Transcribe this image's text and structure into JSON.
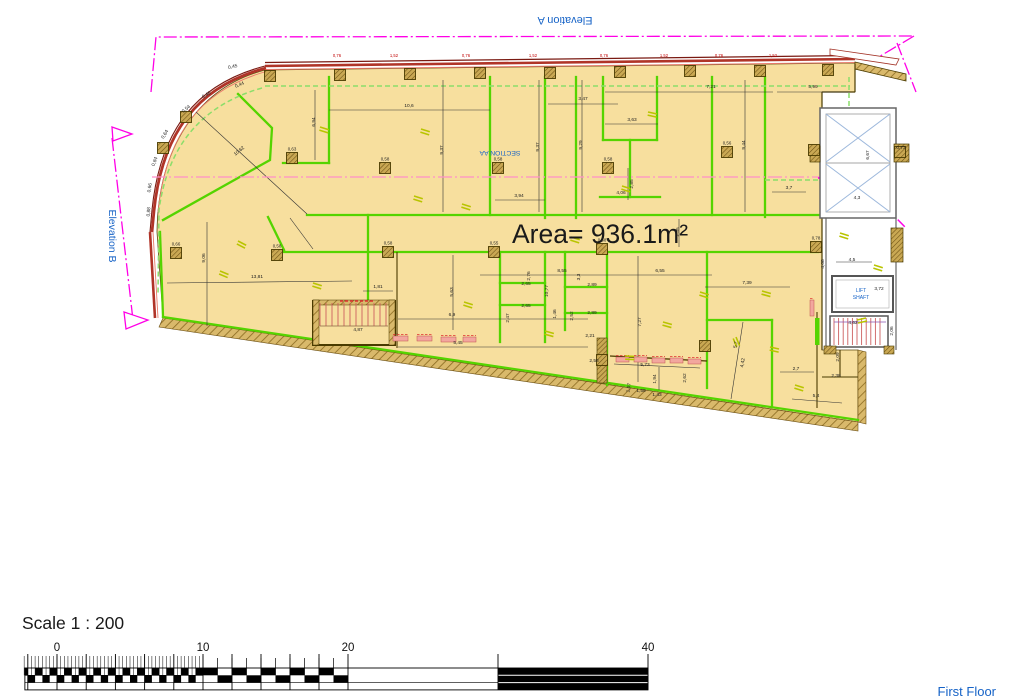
{
  "labels": {
    "area": "Area= 936.1m²",
    "elevation_a": "Elevation A",
    "elevation_b": "Elevation B",
    "section": "SECTION AA",
    "lift_line1": "LIFT",
    "lift_line2": "SHAFT",
    "scale": "Scale 1 : 200",
    "floor": "First Floor"
  },
  "colors": {
    "floor_fill": "#F7DF9E",
    "wall_green": "#55D400",
    "green_dashed": "#8CDE6A",
    "hatch_tan": "#D9B96B",
    "hatch_line": "#8A6A20",
    "wall_red": "#B03428",
    "wall_red_light": "#E8796A",
    "magenta": "#FF00E6",
    "section_pink": "#FF8FC8",
    "blue_text": "#1663C7",
    "brace_blue": "#9DB8DC",
    "dim_text": "#222222",
    "dim_red": "#C00000",
    "door_olive": "#B9C400",
    "sill_pink": "#F2A79E",
    "tread_red": "#CC5F5F",
    "tread_purple": "#8A55B0"
  },
  "scale_bar": {
    "labels": [
      {
        "t": "0",
        "v": 0,
        "x": 57
      },
      {
        "t": "10",
        "v": 10,
        "x": 203
      },
      {
        "t": "20",
        "v": 20,
        "x": 348
      },
      {
        "t": "40",
        "v": 40,
        "x": 648
      }
    ]
  },
  "dims": [
    {
      "t": "0,76",
      "x": 337,
      "y": 57,
      "c": "red"
    },
    {
      "t": "1,52",
      "x": 394,
      "y": 57,
      "c": "red"
    },
    {
      "t": "0,76",
      "x": 466,
      "y": 57,
      "c": "red"
    },
    {
      "t": "1,52",
      "x": 533,
      "y": 57,
      "c": "red"
    },
    {
      "t": "0,76",
      "x": 604,
      "y": 57,
      "c": "red"
    },
    {
      "t": "1,52",
      "x": 664,
      "y": 57,
      "c": "red"
    },
    {
      "t": "0,76",
      "x": 719,
      "y": 57,
      "c": "red"
    },
    {
      "t": "1,52",
      "x": 773,
      "y": 57,
      "c": "red"
    },
    {
      "t": "10,6",
      "x": 409,
      "y": 107
    },
    {
      "t": "3,47",
      "x": 583,
      "y": 100
    },
    {
      "t": "3,63",
      "x": 632,
      "y": 121
    },
    {
      "t": "7,21",
      "x": 711,
      "y": 88
    },
    {
      "t": "5,99",
      "x": 813,
      "y": 88
    },
    {
      "t": "9,37",
      "x": 443,
      "y": 150,
      "r": -90
    },
    {
      "t": "9,37",
      "x": 539,
      "y": 147,
      "r": -90
    },
    {
      "t": "9,29",
      "x": 582,
      "y": 145,
      "r": -90
    },
    {
      "t": "9,44",
      "x": 745,
      "y": 145,
      "r": -90
    },
    {
      "t": "6,94",
      "x": 315,
      "y": 122,
      "r": -90
    },
    {
      "t": "3,94",
      "x": 519,
      "y": 197
    },
    {
      "t": "2,85",
      "x": 633,
      "y": 184,
      "r": -90
    },
    {
      "t": "4,06",
      "x": 621,
      "y": 194
    },
    {
      "t": "2,35",
      "x": 679,
      "y": 232,
      "r": -90
    },
    {
      "t": "3,7",
      "x": 789,
      "y": 189
    },
    {
      "t": "13,81",
      "x": 257,
      "y": 278
    },
    {
      "t": "9,06",
      "x": 205,
      "y": 258,
      "r": -90
    },
    {
      "t": "10,62",
      "x": 240,
      "y": 152,
      "r": -40
    },
    {
      "t": "1,81",
      "x": 378,
      "y": 288
    },
    {
      "t": "5,63",
      "x": 453,
      "y": 292,
      "r": -90
    },
    {
      "t": "10,77",
      "x": 548,
      "y": 291,
      "r": -90
    },
    {
      "t": "6,9",
      "x": 452,
      "y": 316
    },
    {
      "t": "5,45",
      "x": 458,
      "y": 344
    },
    {
      "t": "4,87",
      "x": 358,
      "y": 331
    },
    {
      "t": "8,55",
      "x": 562,
      "y": 272
    },
    {
      "t": "6,55",
      "x": 660,
      "y": 272
    },
    {
      "t": "7,39",
      "x": 747,
      "y": 284
    },
    {
      "t": "7,27",
      "x": 641,
      "y": 322,
      "r": -90
    },
    {
      "t": "2,76",
      "x": 530,
      "y": 276,
      "r": -90
    },
    {
      "t": "2,65",
      "x": 526,
      "y": 285
    },
    {
      "t": "2,65",
      "x": 526,
      "y": 307
    },
    {
      "t": "2,47",
      "x": 509,
      "y": 318,
      "r": -90
    },
    {
      "t": "3,3",
      "x": 580,
      "y": 277,
      "r": -90
    },
    {
      "t": "2,89",
      "x": 592,
      "y": 286
    },
    {
      "t": "2,52",
      "x": 573,
      "y": 316,
      "r": -90
    },
    {
      "t": "2,89",
      "x": 592,
      "y": 314
    },
    {
      "t": "2,21",
      "x": 590,
      "y": 337
    },
    {
      "t": "1,46",
      "x": 556,
      "y": 314,
      "r": -90
    },
    {
      "t": "2,58",
      "x": 594,
      "y": 362
    },
    {
      "t": "5,7",
      "x": 737,
      "y": 345,
      "r": -80
    },
    {
      "t": "4,42",
      "x": 744,
      "y": 363,
      "r": -80
    },
    {
      "t": "5,73",
      "x": 645,
      "y": 366
    },
    {
      "t": "1,94",
      "x": 656,
      "y": 379,
      "r": -90
    },
    {
      "t": "1,07",
      "x": 630,
      "y": 388,
      "r": -80
    },
    {
      "t": "1,58",
      "x": 641,
      "y": 392
    },
    {
      "t": "1,43",
      "x": 657,
      "y": 396
    },
    {
      "t": "2,62",
      "x": 686,
      "y": 378,
      "r": -90
    },
    {
      "t": "2,7",
      "x": 796,
      "y": 370
    },
    {
      "t": "5,4",
      "x": 816,
      "y": 397
    },
    {
      "t": "2,38",
      "x": 836,
      "y": 377
    },
    {
      "t": "2,09",
      "x": 839,
      "y": 357,
      "r": -90
    },
    {
      "t": "6,67",
      "x": 869,
      "y": 155,
      "r": -90
    },
    {
      "t": "0,73",
      "x": 901,
      "y": 149
    },
    {
      "t": "4,3",
      "x": 857,
      "y": 199
    },
    {
      "t": "4,5",
      "x": 852,
      "y": 261
    },
    {
      "t": "4,08",
      "x": 824,
      "y": 264,
      "r": -90
    },
    {
      "t": "3,72",
      "x": 879,
      "y": 290
    },
    {
      "t": "4,62",
      "x": 853,
      "y": 324
    },
    {
      "t": "2,06",
      "x": 893,
      "y": 331,
      "r": -90
    },
    {
      "t": "0,45",
      "x": 233,
      "y": 68,
      "r": -12
    },
    {
      "t": "0,44",
      "x": 240,
      "y": 86,
      "r": -22
    },
    {
      "t": "0,46",
      "x": 207,
      "y": 96,
      "r": -30
    },
    {
      "t": "0,54",
      "x": 187,
      "y": 110,
      "r": -40
    },
    {
      "t": "0,64",
      "x": 166,
      "y": 135,
      "r": -58
    },
    {
      "t": "0,84",
      "x": 156,
      "y": 162,
      "r": -70
    },
    {
      "t": "0,66",
      "x": 151,
      "y": 188,
      "r": -80
    },
    {
      "t": "0,88",
      "x": 150,
      "y": 212,
      "r": -85
    }
  ],
  "columns": [
    {
      "x": 270,
      "y": 76
    },
    {
      "x": 340,
      "y": 75
    },
    {
      "x": 410,
      "y": 74
    },
    {
      "x": 480,
      "y": 73
    },
    {
      "x": 550,
      "y": 73
    },
    {
      "x": 620,
      "y": 72
    },
    {
      "x": 690,
      "y": 71
    },
    {
      "x": 760,
      "y": 71
    },
    {
      "x": 828,
      "y": 70
    },
    {
      "x": 292,
      "y": 158,
      "l": "0,63"
    },
    {
      "x": 385,
      "y": 168,
      "l": "0,58"
    },
    {
      "x": 498,
      "y": 168,
      "l": "0,58"
    },
    {
      "x": 608,
      "y": 168,
      "l": "0,58"
    },
    {
      "x": 727,
      "y": 152,
      "l": "0,56"
    },
    {
      "x": 388,
      "y": 252,
      "l": "0,58"
    },
    {
      "x": 494,
      "y": 252,
      "l": "0,55"
    },
    {
      "x": 602,
      "y": 249,
      "l": "0,58"
    },
    {
      "x": 277,
      "y": 255,
      "l": "0,58"
    },
    {
      "x": 176,
      "y": 253,
      "l": "0,66"
    },
    {
      "x": 186,
      "y": 117
    },
    {
      "x": 163,
      "y": 148
    },
    {
      "x": 816,
      "y": 247,
      "l": "0,78"
    },
    {
      "x": 900,
      "y": 152
    },
    {
      "x": 814,
      "y": 150
    },
    {
      "x": 705,
      "y": 346
    },
    {
      "x": 602,
      "y": 360
    }
  ],
  "doors": [
    {
      "x": 320,
      "y": 127,
      "r": 30
    },
    {
      "x": 421,
      "y": 129,
      "r": 30
    },
    {
      "x": 648,
      "y": 112,
      "r": 25
    },
    {
      "x": 622,
      "y": 186,
      "r": 30
    },
    {
      "x": 571,
      "y": 237,
      "r": 30
    },
    {
      "x": 462,
      "y": 204,
      "r": 30
    },
    {
      "x": 414,
      "y": 196,
      "r": 30
    },
    {
      "x": 238,
      "y": 241,
      "r": 40
    },
    {
      "x": 220,
      "y": 271,
      "r": 35
    },
    {
      "x": 313,
      "y": 283,
      "r": 30
    },
    {
      "x": 464,
      "y": 302,
      "r": 30
    },
    {
      "x": 545,
      "y": 331,
      "r": 28
    },
    {
      "x": 663,
      "y": 322,
      "r": 28
    },
    {
      "x": 736,
      "y": 337,
      "r": 80
    },
    {
      "x": 770,
      "y": 347,
      "r": 25
    },
    {
      "x": 700,
      "y": 292,
      "r": 30
    },
    {
      "x": 762,
      "y": 291,
      "r": 28
    },
    {
      "x": 840,
      "y": 233,
      "r": 30
    },
    {
      "x": 857,
      "y": 320,
      "r": 0
    },
    {
      "x": 874,
      "y": 265,
      "r": 30
    },
    {
      "x": 625,
      "y": 356,
      "r": 15
    },
    {
      "x": 795,
      "y": 385,
      "r": 30
    }
  ],
  "sills": [
    {
      "x": 393,
      "y": 336,
      "w": 15
    },
    {
      "x": 417,
      "y": 336,
      "w": 15
    },
    {
      "x": 441,
      "y": 337,
      "w": 15
    },
    {
      "x": 463,
      "y": 337,
      "w": 13
    },
    {
      "x": 616,
      "y": 357,
      "w": 13
    },
    {
      "x": 634,
      "y": 357,
      "w": 13
    },
    {
      "x": 652,
      "y": 358,
      "w": 13
    },
    {
      "x": 670,
      "y": 358,
      "w": 13
    },
    {
      "x": 688,
      "y": 359,
      "w": 13
    },
    {
      "x": 810,
      "y": 300,
      "w": 4,
      "h": 16
    }
  ]
}
